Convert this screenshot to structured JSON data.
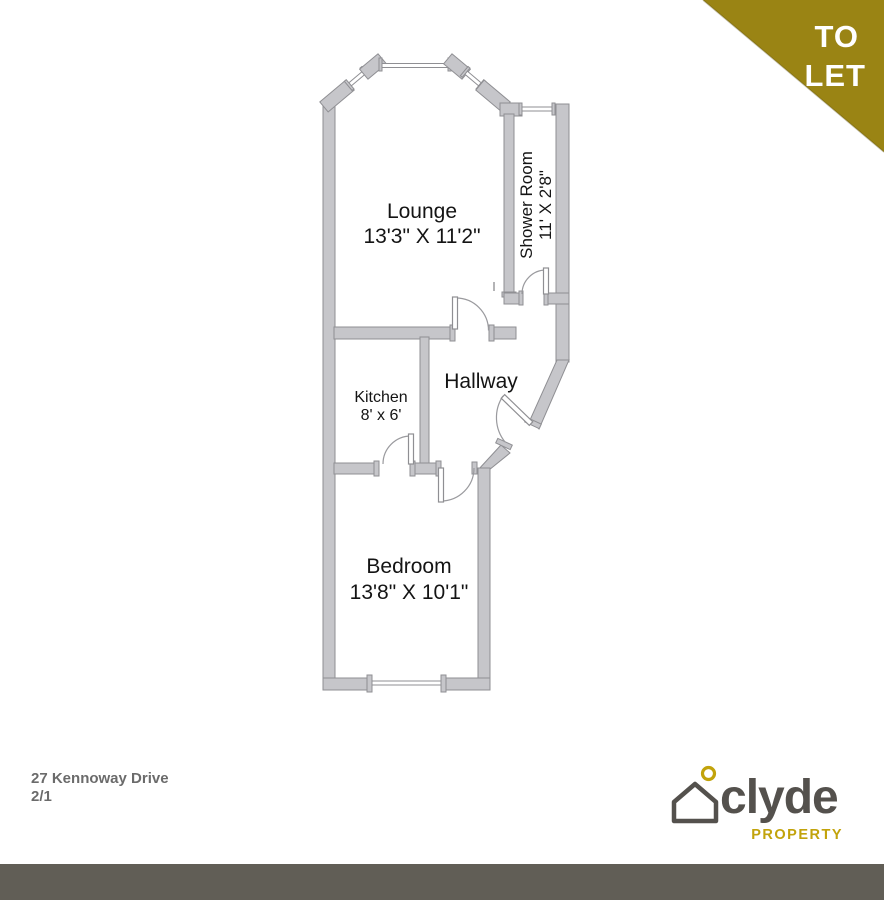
{
  "banner": {
    "line1": "TO",
    "line2": "LET"
  },
  "floor_plan": {
    "rooms": [
      {
        "id": "lounge",
        "name": "Lounge",
        "dimensions": "13'3\" X 11'2\""
      },
      {
        "id": "shower_room",
        "name": "Shower Room",
        "dimensions": "11' X 2'8\""
      },
      {
        "id": "kitchen",
        "name": "Kitchen",
        "dimensions": "8' x 6'"
      },
      {
        "id": "hallway",
        "name": "Hallway",
        "dimensions": ""
      },
      {
        "id": "bedroom",
        "name": "Bedroom",
        "dimensions": "13'8\" X 10'1\""
      }
    ]
  },
  "footer": {
    "address_line1": "27 Kennoway Drive",
    "address_line2": "2/1"
  },
  "brand": {
    "name": "clyde",
    "tagline": "PROPERTY"
  },
  "colors": {
    "accent_gold": "#9a8414",
    "logo_gold": "#c2a30b",
    "logo_gray": "#54514d",
    "wall_gray": "#c6c6ca",
    "footer_bar": "#615e56",
    "address_text": "#6b6b6b"
  }
}
